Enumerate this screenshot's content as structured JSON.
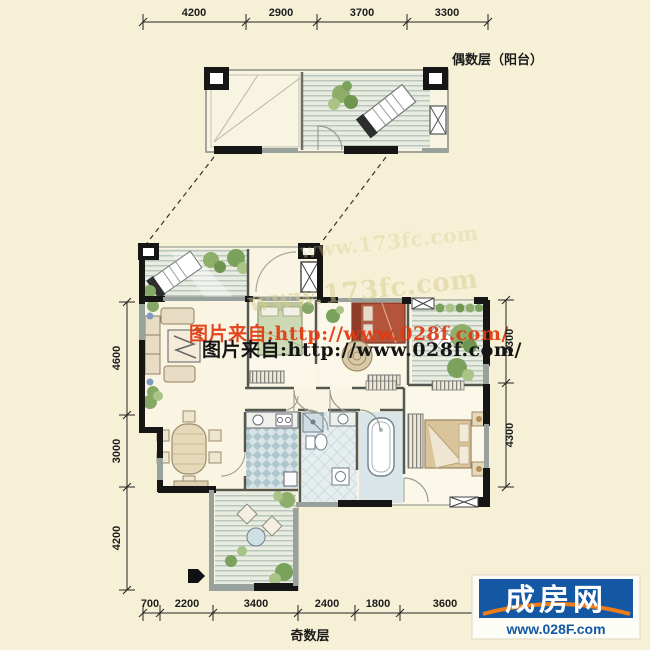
{
  "labels": {
    "even_floor": "偶数层（阳台）",
    "odd_floor": "奇数层"
  },
  "dimensions": {
    "top": [
      "4200",
      "2900",
      "3700",
      "3300"
    ],
    "bottom": [
      "700",
      "2200",
      "3400",
      "2400",
      "1800",
      "3600"
    ],
    "left": [
      "4600",
      "3000",
      "4200"
    ],
    "right": [
      "3300",
      "4300"
    ]
  },
  "watermarks": {
    "photo_source_red": "图片来自:http://www.028f.com/",
    "photo_source_black": "图片来自:http://www.028f.com/",
    "ghost_site": "www.173fc.com"
  },
  "logo": {
    "brand": "成房网",
    "website": "www.028F.com"
  },
  "colors": {
    "background": "#f6f1d6",
    "wall_black": "#161616",
    "window_gray": "#98a19b",
    "deck_line": "#a7bab1",
    "plant_green": "#7ba25c",
    "logo_blue": "#1458a4",
    "logo_orange": "#ee7d18",
    "watermark_red": "#e2390e"
  }
}
